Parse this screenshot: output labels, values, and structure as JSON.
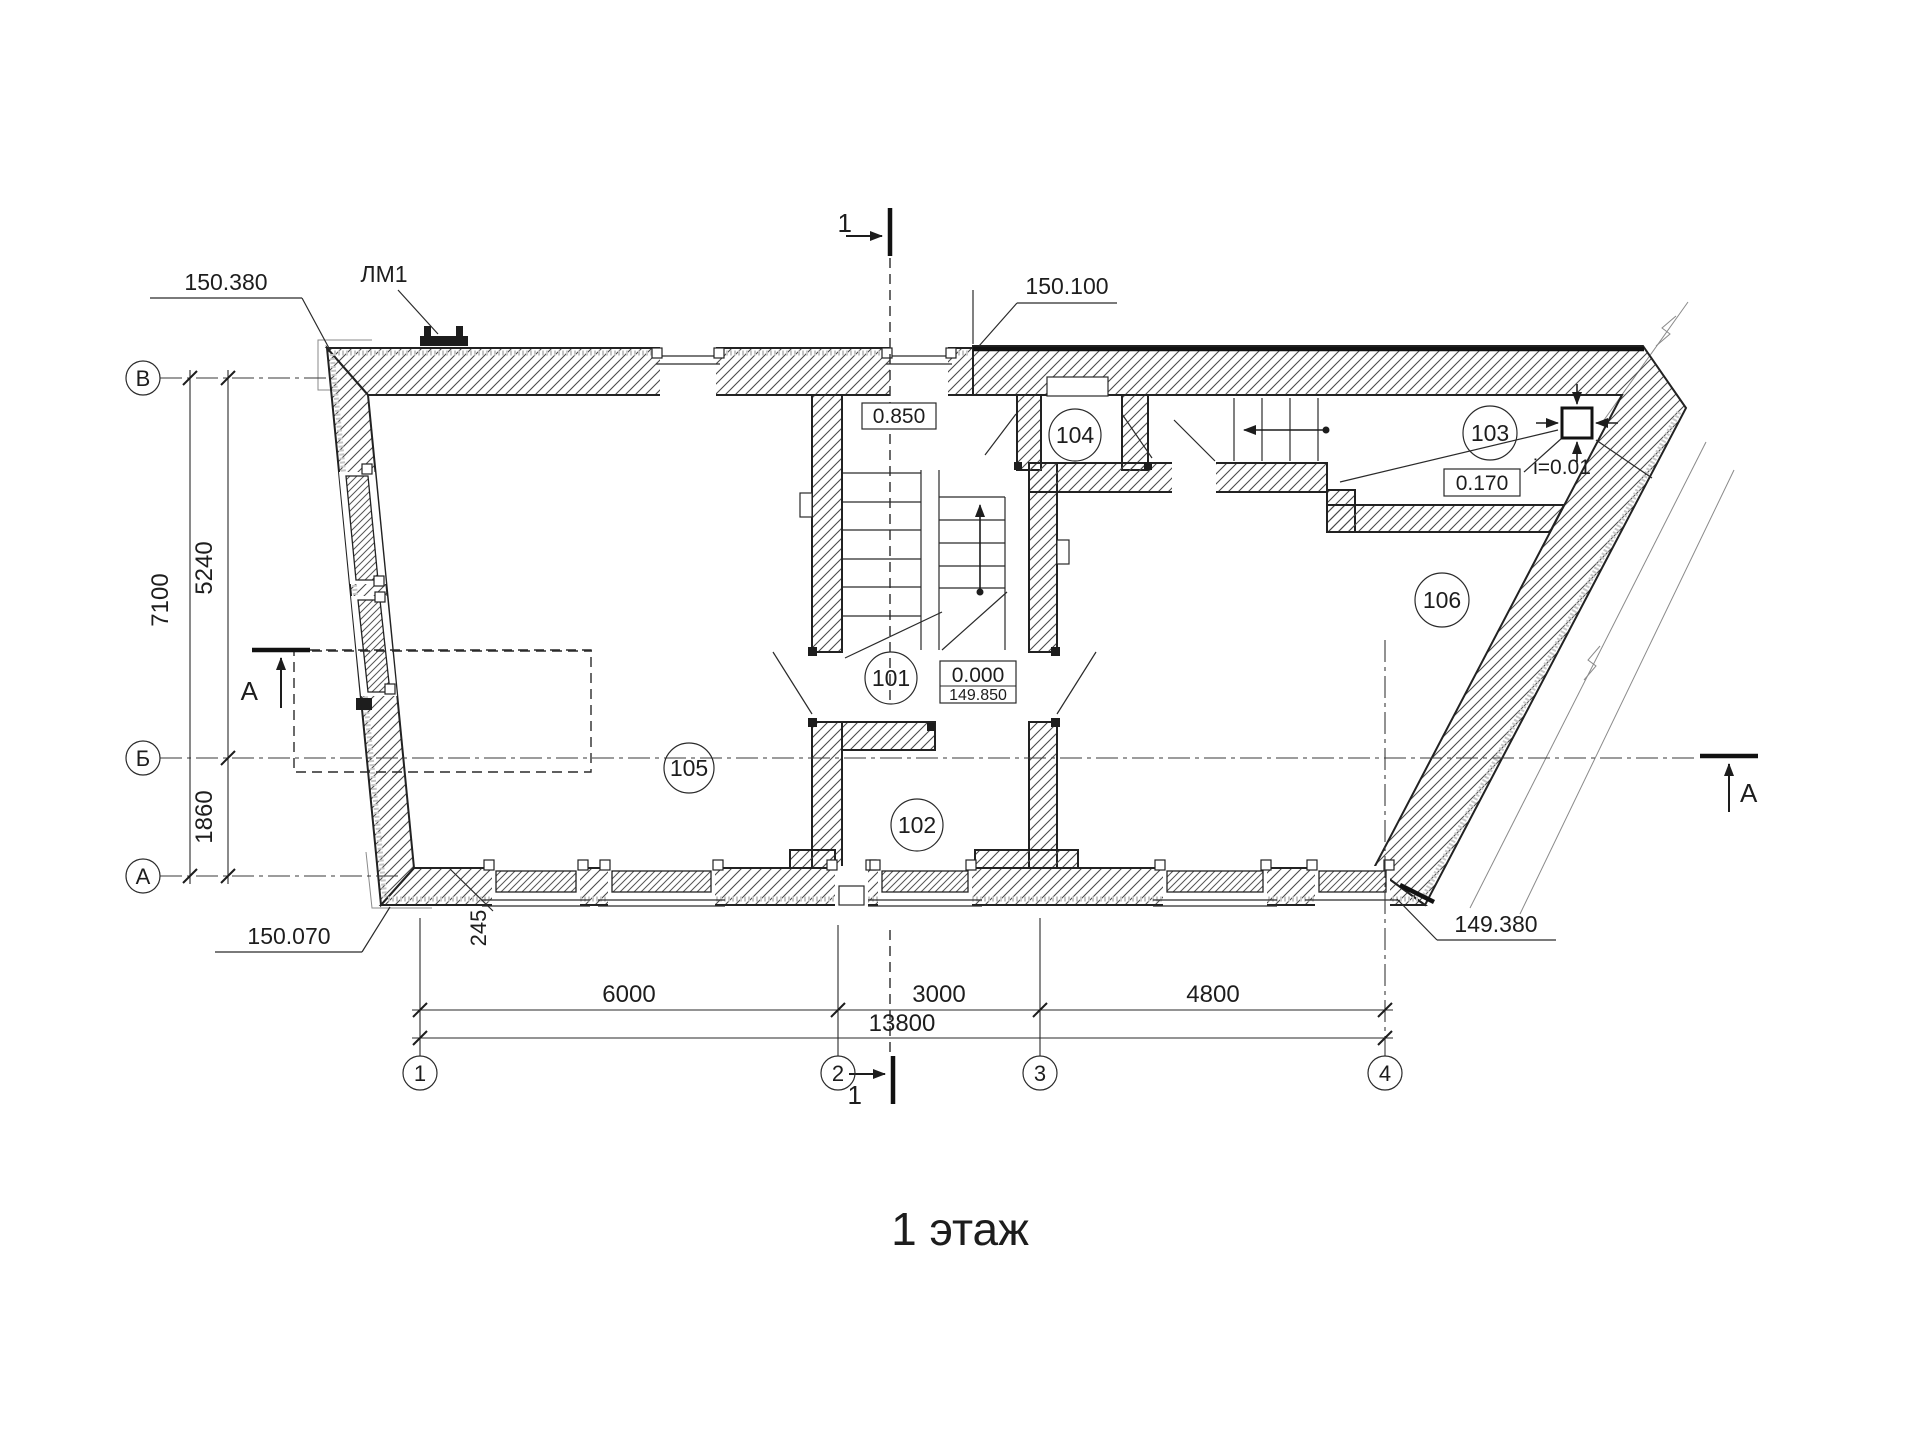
{
  "title": "1 этаж",
  "grid": {
    "rows": [
      {
        "label": "В"
      },
      {
        "label": "Б"
      },
      {
        "label": "А"
      }
    ],
    "cols": [
      {
        "label": "1"
      },
      {
        "label": "2"
      },
      {
        "label": "3"
      },
      {
        "label": "4"
      }
    ]
  },
  "dims": {
    "left_total": "7100",
    "left_upper": "5240",
    "left_lower": "1860",
    "bottom_seg1": "6000",
    "bottom_seg2": "3000",
    "bottom_seg3": "4800",
    "bottom_total": "13800",
    "wall_offset": "245"
  },
  "levels": {
    "top_left": "150.380",
    "top_middle": "150.100",
    "bottom_left": "150.070",
    "bottom_right": "149.380",
    "landing": "0.850",
    "ramp": "0.170",
    "slope": "i=0.01",
    "floor_rel": "0.000",
    "floor_abs": "149.850"
  },
  "entrance_label": "ЛМ1",
  "rooms": [
    {
      "number": "101"
    },
    {
      "number": "102"
    },
    {
      "number": "103"
    },
    {
      "number": "104"
    },
    {
      "number": "105"
    },
    {
      "number": "106"
    }
  ],
  "sections": {
    "cut1": "1",
    "cutA": "А"
  }
}
